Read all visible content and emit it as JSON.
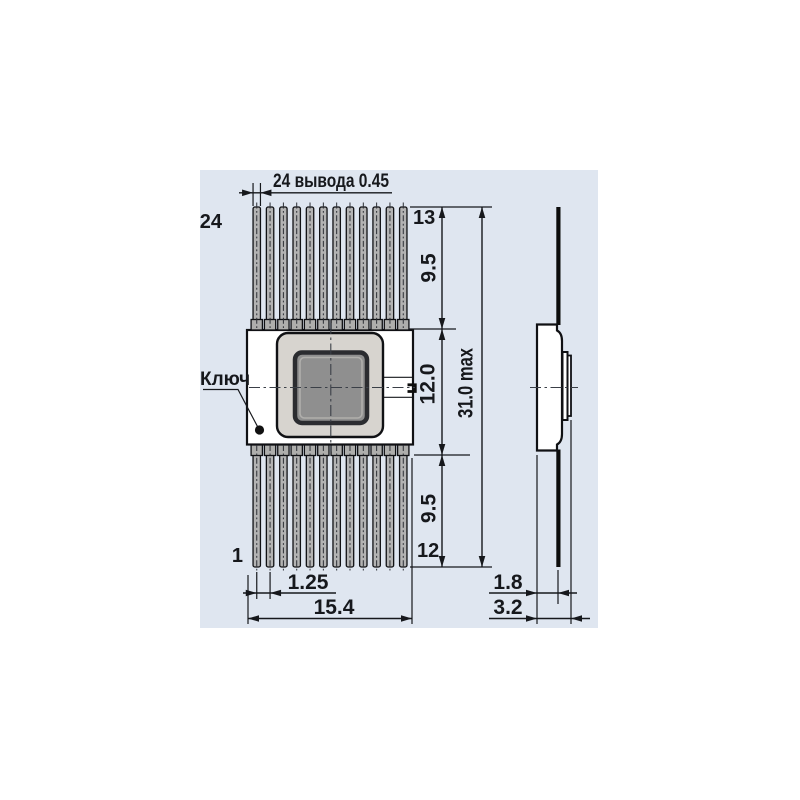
{
  "panel": {
    "background": "#dfe6f0"
  },
  "drawing": {
    "top_dimension_label": "24 вывода 0.45",
    "key_label": "Ключ",
    "pin_labels": {
      "top_left": "24",
      "top_right": "13",
      "bottom_left": "1",
      "bottom_right": "12"
    },
    "dimensions": {
      "upper_leads_length": "9.5",
      "body_height": "12.0",
      "overall_height": "31.0 max",
      "lower_leads_length": "9.5",
      "lead_pitch": "1.25",
      "body_width": "15.4",
      "side_body_thickness": "1.8",
      "side_overall_thickness": "3.2"
    },
    "colors": {
      "panel": "#dfe6f0",
      "line": "#16181c",
      "pin_fill": "#b3b3b3",
      "shoulder_fill": "#aeaeac",
      "cap_fill": "#d7d4cf",
      "die_fill": "#8f8f8f",
      "die_ring": "#2b2c30",
      "key_dot": "#111111"
    }
  }
}
